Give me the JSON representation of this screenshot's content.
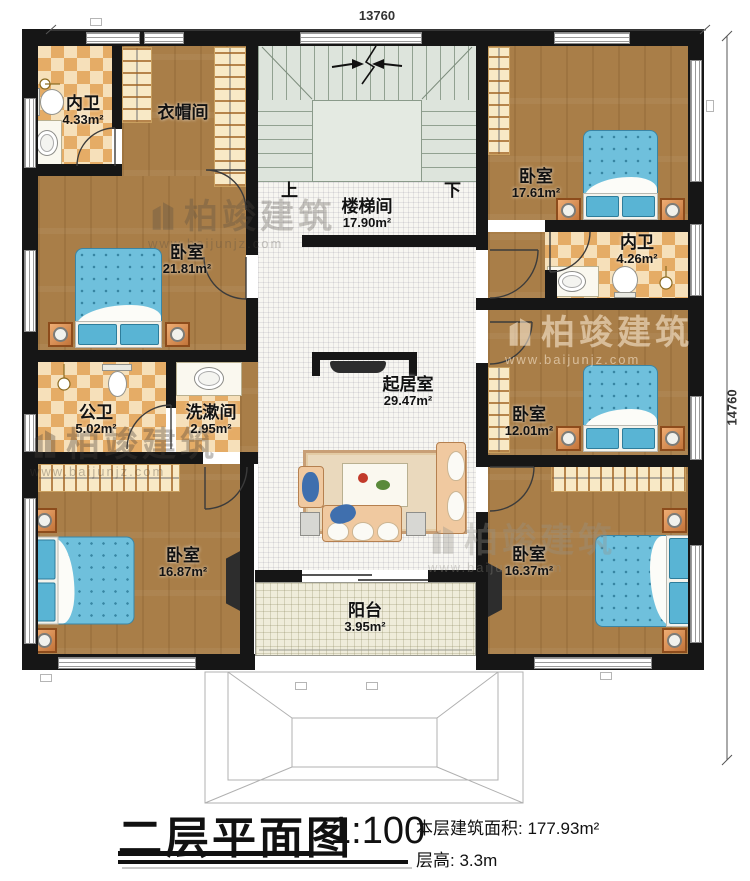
{
  "title_block": {
    "title": "二层平面图",
    "scale": "1:100",
    "floor_area": "本层建筑面积: 177.93m²",
    "floor_height": "层高: 3.3m"
  },
  "dimensions": {
    "top": "13760",
    "right": "14760"
  },
  "stairs": {
    "up": "上",
    "down": "下"
  },
  "watermark": {
    "brand": "柏竣建筑",
    "url": "www.baijunjz.com"
  },
  "rooms": [
    {
      "name": "内卫",
      "area": "4.33m²"
    },
    {
      "name": "衣帽间",
      "area": ""
    },
    {
      "name": "卧室",
      "area": "21.81m²"
    },
    {
      "name": "公卫",
      "area": "5.02m²"
    },
    {
      "name": "洗漱间",
      "area": "2.95m²"
    },
    {
      "name": "卧室",
      "area": "16.87m²"
    },
    {
      "name": "楼梯间",
      "area": "17.90m²"
    },
    {
      "name": "起居室",
      "area": "29.47m²"
    },
    {
      "name": "阳台",
      "area": "3.95m²"
    },
    {
      "name": "卧室",
      "area": "17.61m²"
    },
    {
      "name": "内卫",
      "area": "4.26m²"
    },
    {
      "name": "卧室",
      "area": "12.01m²"
    },
    {
      "name": "卧室",
      "area": "16.37m²"
    }
  ]
}
